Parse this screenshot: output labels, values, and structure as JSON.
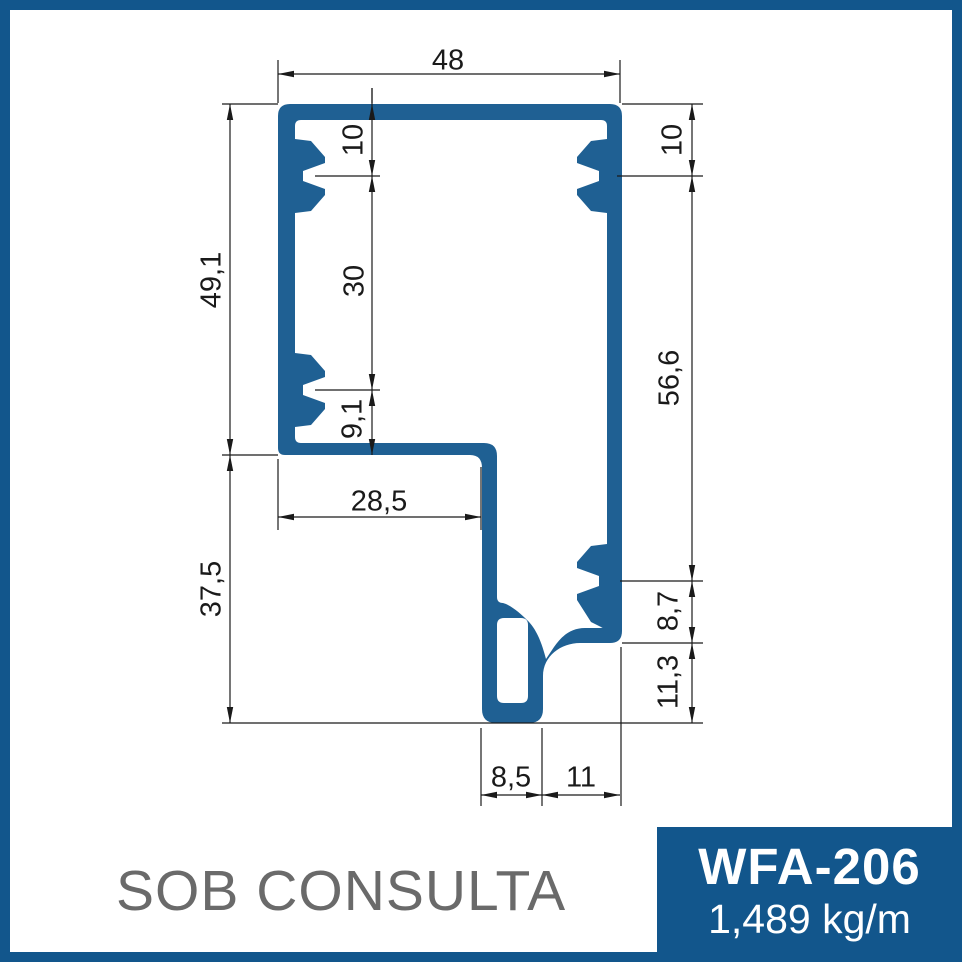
{
  "product": {
    "code": "WFA-206",
    "weight": "1,489 kg/m",
    "availability": "SOB CONSULTA"
  },
  "colors": {
    "frame": "#12568C",
    "badge_bg": "#12568C",
    "badge_text": "#FFFFFF",
    "profile": "#1F6093",
    "dimension_lines": "#1A1A1A",
    "watermark_text": "#6A6A6A"
  },
  "drawing": {
    "type": "technical-profile-cross-section",
    "unit": "mm",
    "overall_width_mm": 48,
    "overall_height_mm": 86.6,
    "dimensions": [
      {
        "id": "width-top",
        "label": "48",
        "orient": "h",
        "line": 74,
        "from": 278,
        "to": 620,
        "label_x": 448,
        "label_y": 62
      },
      {
        "id": "slot-top-offset-left",
        "label": "10",
        "orient": "v",
        "line": 372,
        "from": 104,
        "to": 176,
        "label_x": 355,
        "label_y": 140,
        "overshoot_from": 88
      },
      {
        "id": "slot-spacing-left",
        "label": "30",
        "orient": "v",
        "line": 372,
        "from": 176,
        "to": 390,
        "label_x": 356,
        "label_y": 281
      },
      {
        "id": "slot-bottom-offset-left",
        "label": "9,1",
        "orient": "v",
        "line": 372,
        "from": 390,
        "to": 455,
        "label_x": 354,
        "label_y": 419
      },
      {
        "id": "height-upper-left",
        "label": "49,1",
        "orient": "v",
        "line": 230,
        "from": 104,
        "to": 455,
        "label_x": 213,
        "label_y": 280
      },
      {
        "id": "height-lower-left",
        "label": "37,5",
        "orient": "v",
        "line": 230,
        "from": 455,
        "to": 723,
        "label_x": 213,
        "label_y": 589
      },
      {
        "id": "slot-top-offset-right",
        "label": "10",
        "orient": "v",
        "line": 692,
        "from": 104,
        "to": 176,
        "label_x": 674,
        "label_y": 140
      },
      {
        "id": "height-right",
        "label": "56,6",
        "orient": "v",
        "line": 692,
        "from": 176,
        "to": 581,
        "label_x": 671,
        "label_y": 378
      },
      {
        "id": "step-height-right",
        "label": "8,7",
        "orient": "v",
        "line": 692,
        "from": 581,
        "to": 643,
        "label_x": 670,
        "label_y": 611
      },
      {
        "id": "leg-height-right",
        "label": "11,3",
        "orient": "v",
        "line": 692,
        "from": 643,
        "to": 723,
        "label_x": 670,
        "label_y": 682
      },
      {
        "id": "shelf-width",
        "label": "28,5",
        "orient": "h",
        "line": 517,
        "from": 278,
        "to": 481,
        "label_x": 379,
        "label_y": 503
      },
      {
        "id": "foot-width",
        "label": "8,5",
        "orient": "h",
        "line": 795,
        "from": 481,
        "to": 542,
        "label_x": 511,
        "label_y": 779
      },
      {
        "id": "bottom-offset",
        "label": "11",
        "orient": "h",
        "line": 795,
        "from": 542,
        "to": 620,
        "label_x": 581,
        "label_y": 779
      }
    ],
    "extension_lines": [
      [
        222,
        104,
        278,
        104
      ],
      [
        222,
        455,
        278,
        455
      ],
      [
        222,
        723,
        703,
        723
      ],
      [
        278,
        60,
        278,
        103
      ],
      [
        620,
        60,
        620,
        103
      ],
      [
        372,
        88,
        372,
        103
      ],
      [
        315,
        176,
        380,
        176
      ],
      [
        315,
        390,
        380,
        390
      ],
      [
        622,
        104,
        703,
        104
      ],
      [
        617,
        176,
        703,
        176
      ],
      [
        620,
        581,
        703,
        581
      ],
      [
        622,
        643,
        703,
        643
      ],
      [
        278,
        459,
        278,
        530
      ],
      [
        481,
        467,
        481,
        530
      ],
      [
        481,
        728,
        481,
        806
      ],
      [
        542,
        728,
        542,
        806
      ],
      [
        621,
        647,
        621,
        806
      ]
    ]
  }
}
